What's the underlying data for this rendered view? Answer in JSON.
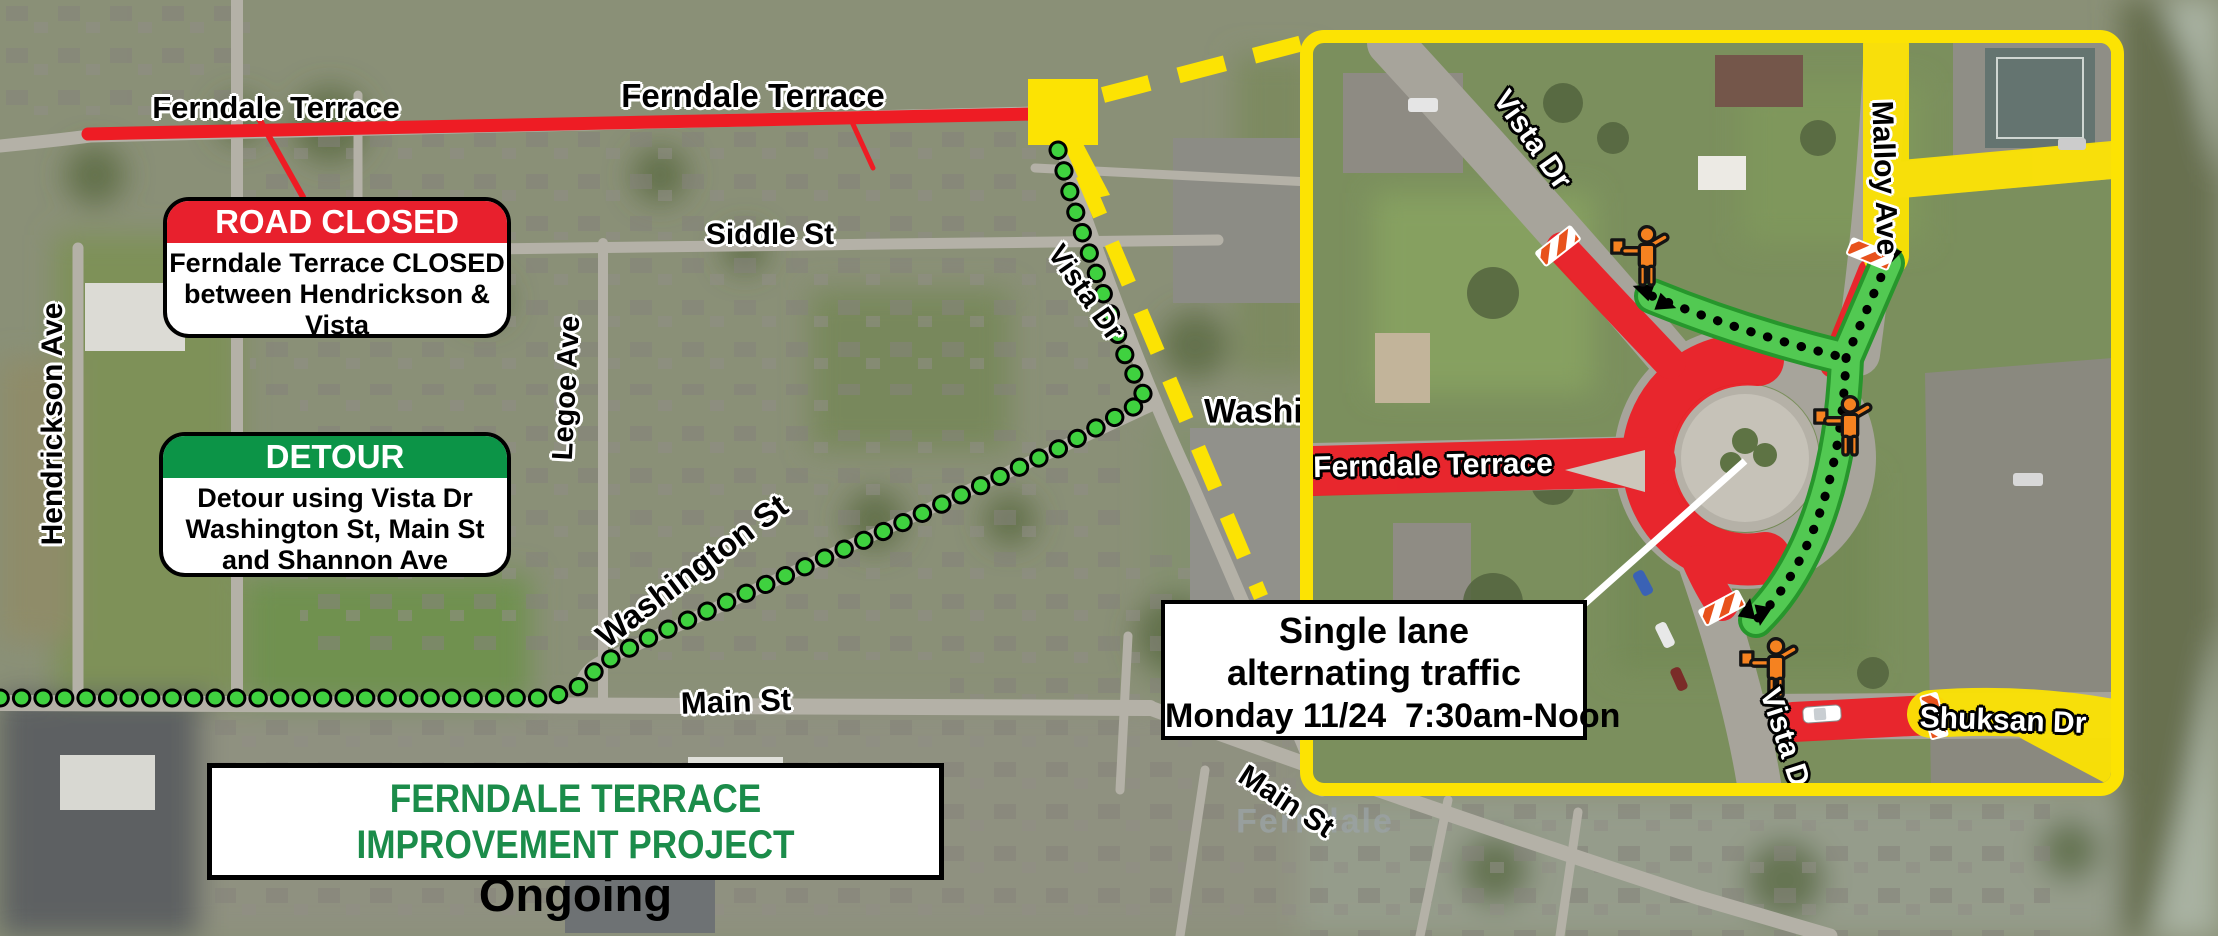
{
  "boxes": {
    "road_closed": {
      "header": "ROAD CLOSED",
      "lines": [
        "Ferndale Terrace CLOSED",
        "between Hendrickson & Vista",
        "Local traffic only"
      ]
    },
    "detour": {
      "header": "DETOUR",
      "lines": [
        "Detour using Vista Dr",
        "Washington St, Main St",
        "and Shannon Ave"
      ]
    },
    "project": {
      "title": "FERNDALE TERRACE IMPROVEMENT PROJECT",
      "status": "Ongoing"
    },
    "single_lane": {
      "lines": [
        "Single lane",
        "alternating traffic",
        "Monday 11/24  7:30am-Noon"
      ]
    }
  },
  "map_labels": {
    "ferndale_terrace_w": "Ferndale Terrace",
    "ferndale_terrace_e": "Ferndale Terrace",
    "siddle_st": "Siddle St",
    "vista_dr": "Vista Dr",
    "legoe_ave": "Legoe Ave",
    "washington_st": "Washington St",
    "hendrickson_ave": "Hendrickson Ave",
    "main_st": "Main St",
    "washington_st_cut": "Washington St",
    "main_st_se": "Main St",
    "ferndale_city": "Ferndale"
  },
  "inset_labels": {
    "vista_dr_n": "Vista Dr",
    "malloy_ave": "Malloy Ave",
    "ferndale_terrace": "Ferndale Terrace",
    "vista_dr_s": "Vista Dr",
    "shuksan_dr": "Shuksan Dr"
  },
  "icons": {
    "flagger": "construction-flagger-icon",
    "barrier": "striped-closure-barrier-icon",
    "route_dots": "detour-route-dotted-line",
    "two_way_arrows": "two-way-traffic-arrows",
    "callout_square": "zoom-callout-square"
  },
  "colors": {
    "closed_red": "#ee1c24",
    "header_red": "#e8202d",
    "detour_green": "#0c9447",
    "title_green": "#1b8c4a",
    "callout_yellow": "#fce303",
    "route_dot_green": "#3fd13f",
    "open_lane_green": "#52c952",
    "flagger_orange": "#f58220"
  }
}
